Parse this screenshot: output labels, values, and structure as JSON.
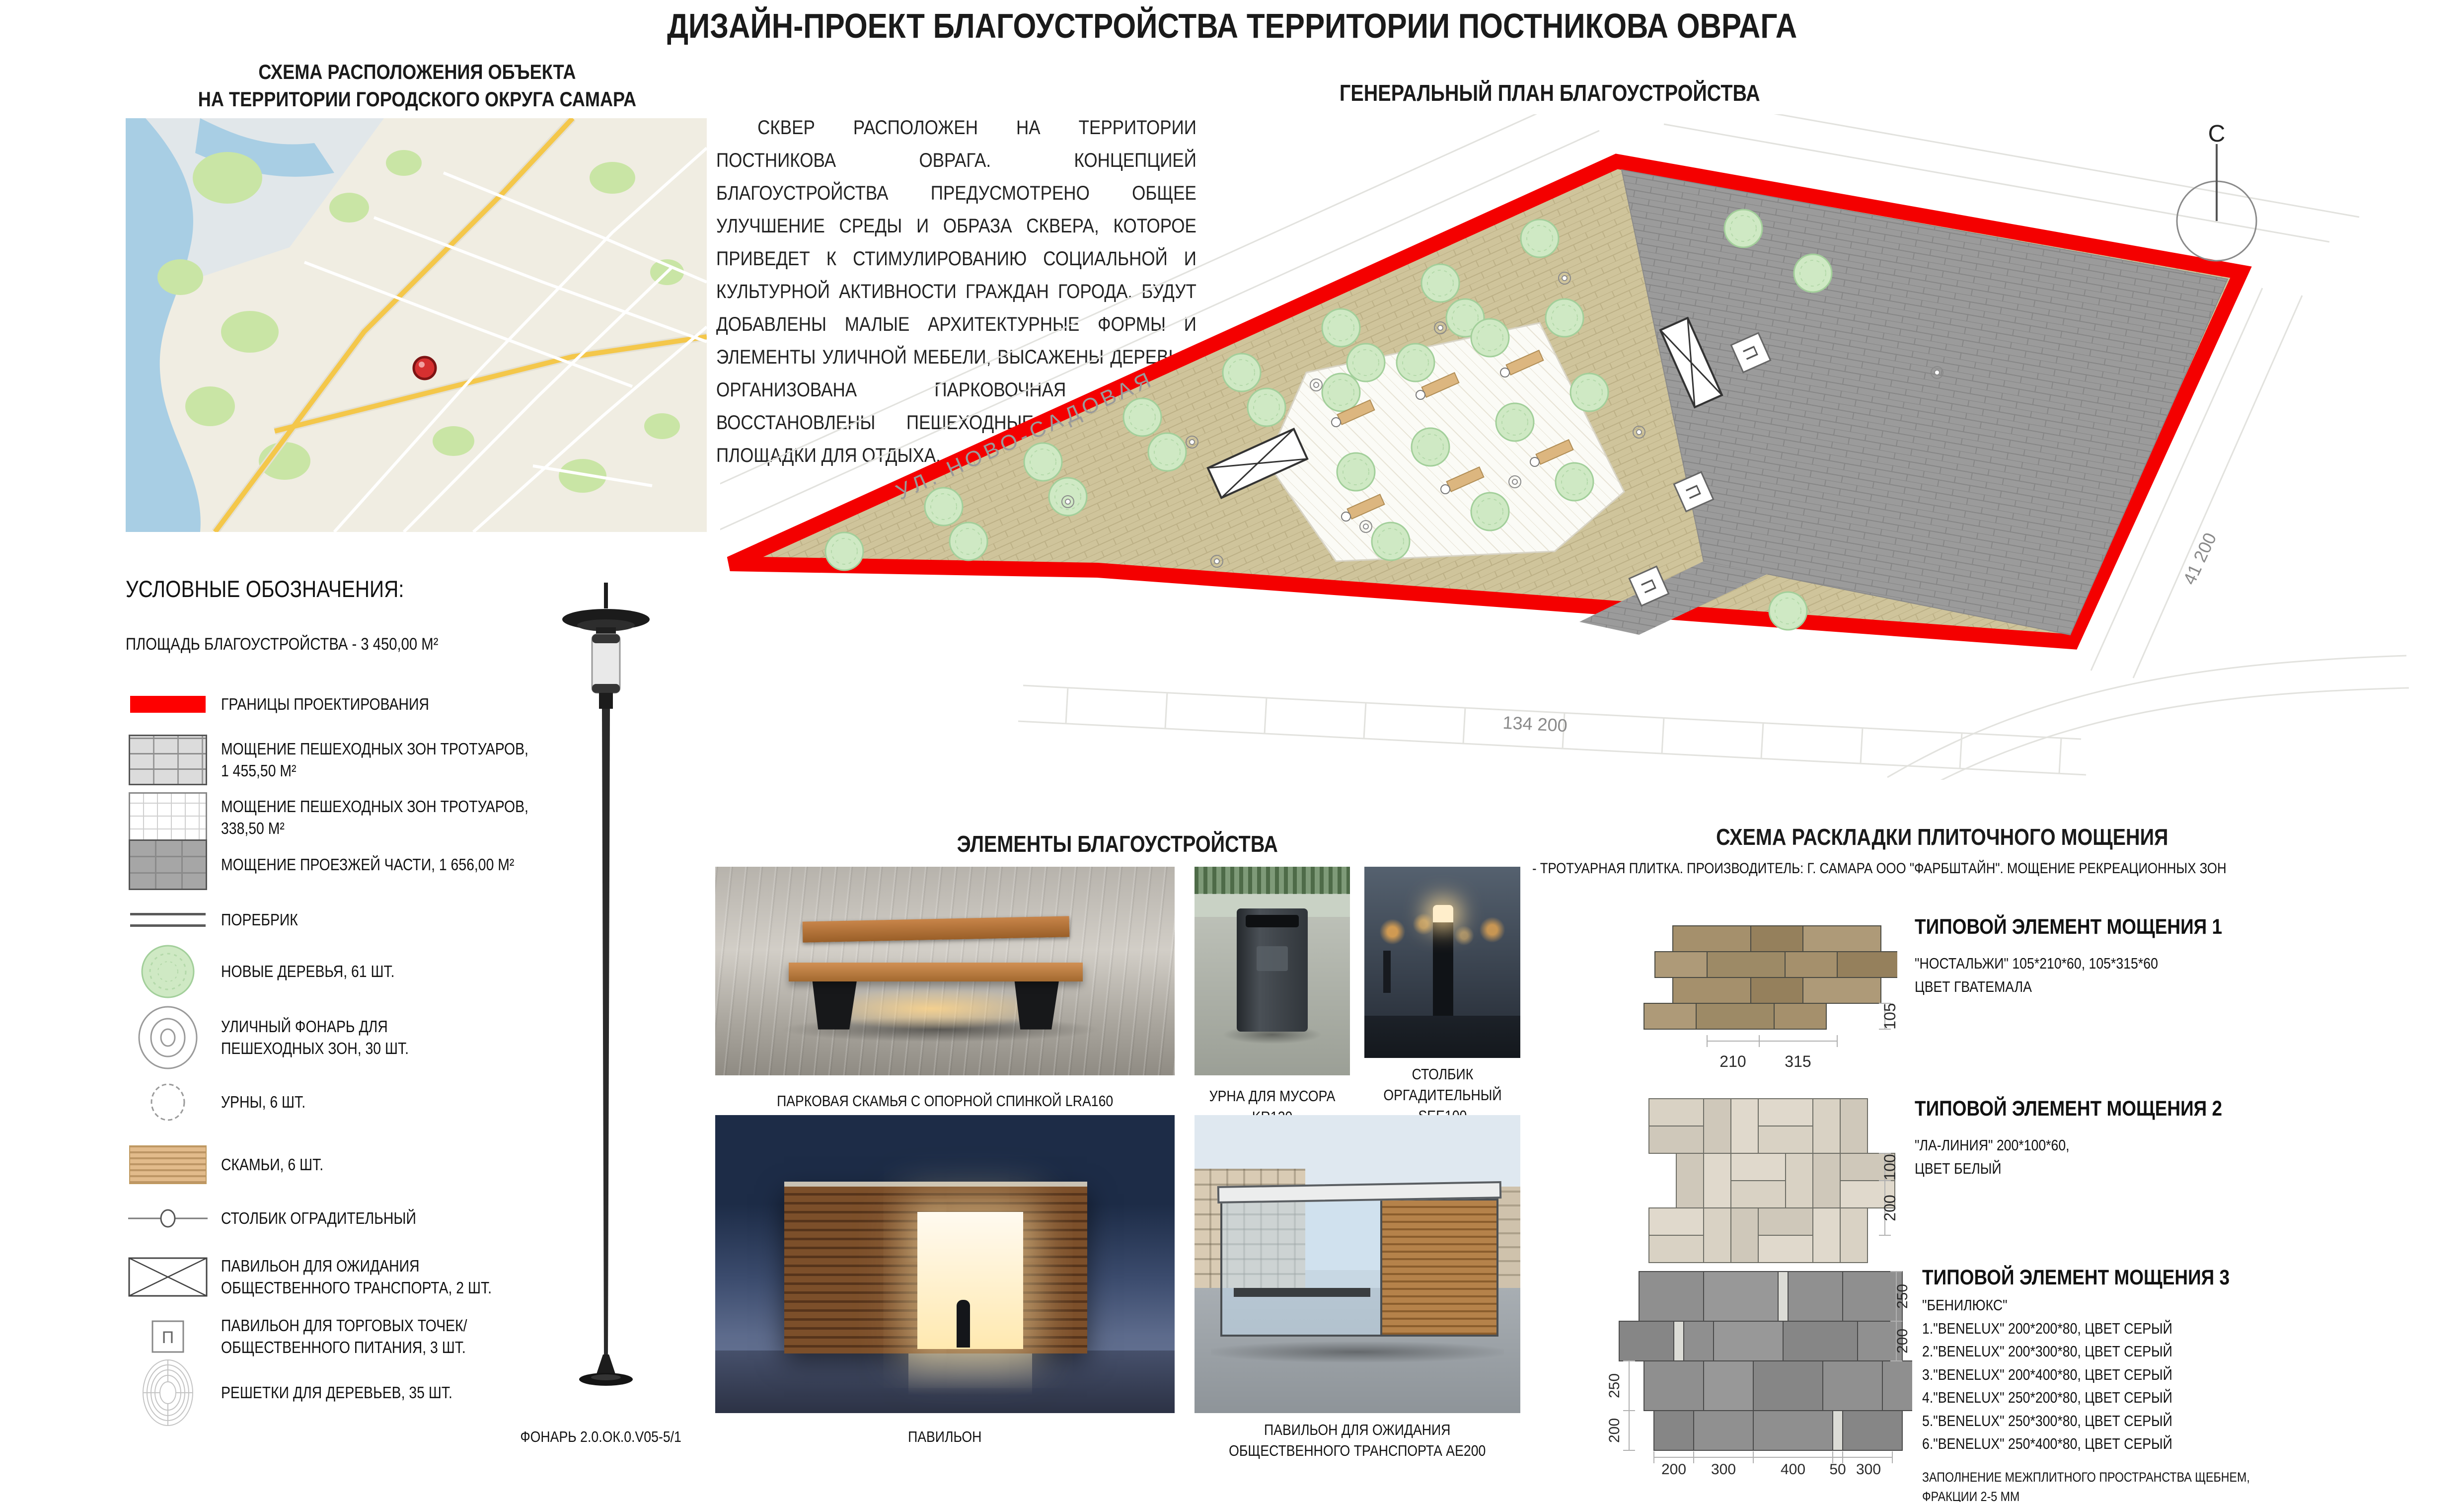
{
  "title": "ДИЗАЙН-ПРОЕКТ БЛАГОУСТРОЙСТВА  ТЕРРИТОРИИ ПОСТНИКОВА ОВРАГА",
  "location_scheme": {
    "title": "СХЕМА РАСПОЛОЖЕНИЯ ОБЪЕКТА\nНА ТЕРРИТОРИИ ГОРОДСКОГО ОКРУГА САМАРА"
  },
  "description": "СКВЕР РАСПОЛОЖЕН НА ТЕРРИТОРИИ ПОСТНИКОВА ОВРАГА. КОНЦЕПЦИЕЙ БЛАГОУСТРОЙСТВА ПРЕДУСМОТРЕНО ОБЩЕЕ УЛУЧШЕНИЕ СРЕДЫ И ОБРАЗА СКВЕРА, КОТОРОЕ ПРИВЕДЕТ К СТИМУЛИРОВАНИЮ СОЦИАЛЬНОЙ И КУЛЬТУРНОЙ АКТИВНОСТИ ГРАЖДАН ГОРОДА. БУДУТ ДОБАВЛЕНЫ МАЛЫЕ АРХИТЕКТУРНЫЕ ФОРМЫ И ЭЛЕМЕНТЫ УЛИЧНОЙ МЕБЕЛИ, ВЫСАЖЕНЫ ДЕРЕВЬЯ, ОРГАНИЗОВАНА ПАРКОВОЧНАЯ ЗОНА, ВОССТАНОВЛЕНЫ ПЕШЕХОДНЫЕ ДОРОЖКИ И ПЛОЩАДКИ ДЛЯ ОТДЫХА.",
  "general_plan": {
    "title": "ГЕНЕРАЛЬНЫЙ ПЛАН БЛАГОУСТРОЙСТВА",
    "street_label": "УЛ. НОВО-САДОВАЯ",
    "dim_bottom": "134 200",
    "dim_right": "41 200",
    "north_label": "С",
    "pavilion_marker": "П"
  },
  "legend": {
    "heading": "УСЛОВНЫЕ ОБОЗНАЧЕНИЯ:",
    "area_line": "ПЛОЩАДЬ БЛАГОУСТРОЙСТВА - 3 450,00 М²",
    "items": [
      {
        "label": "ГРАНИЦЫ ПРОЕКТИРОВАНИЯ"
      },
      {
        "label": "МОЩЕНИЕ ПЕШЕХОДНЫХ ЗОН ТРОТУАРОВ,\n1 455,50 М²"
      },
      {
        "label": "МОЩЕНИЕ ПЕШЕХОДНЫХ ЗОН ТРОТУАРОВ,\n338,50 М²"
      },
      {
        "label": "МОЩЕНИЕ ПРОЕЗЖЕЙ ЧАСТИ, 1 656,00 М²"
      },
      {
        "label": "ПОРЕБРИК"
      },
      {
        "label": "НОВЫЕ ДЕРЕВЬЯ, 61 ШТ."
      },
      {
        "label": "УЛИЧНЫЙ ФОНАРЬ ДЛЯ\nПЕШЕХОДНЫХ ЗОН, 30 ШТ."
      },
      {
        "label": "УРНЫ, 6 ШТ."
      },
      {
        "label": "СКАМЬИ, 6 ШТ."
      },
      {
        "label": "СТОЛБИК ОГРАДИТЕЛЬНЫЙ"
      },
      {
        "label": "ПАВИЛЬОН ДЛЯ ОЖИДАНИЯ\nОБЩЕСТВЕННОГО ТРАНСПОРТА, 2 ШТ."
      },
      {
        "label": "ПАВИЛЬОН ДЛЯ ТОРГОВЫХ ТОЧЕК/\nОБЩЕСТВЕННОГО ПИТАНИЯ, 3 ШТ."
      },
      {
        "label": "РЕШЕТКИ ДЛЯ ДЕРЕВЬЕВ, 35 ШТ."
      }
    ],
    "lamp_caption": "ФОНАРЬ 2.0.ОК.0.V05-5/1"
  },
  "elements": {
    "heading": "ЭЛЕМЕНТЫ БЛАГОУСТРОЙСТВА",
    "bench_caption": "ПАРКОВАЯ СКАМЬЯ С ОПОРНОЙ СПИНКОЙ LRA160",
    "urn_caption": "УРНА ДЛЯ МУСОРА\nKR120",
    "bollard_caption": "СТОЛБИК\nОРГАДИТЕЛЬНЫЙ\nSEE100",
    "pavilion_caption": "ПАВИЛЬОН",
    "bus_caption": "ПАВИЛЬОН ДЛЯ ОЖИДАНИЯ\nОБЩЕСТВЕННОГО ТРАНСПОРТА АЕ200"
  },
  "paving": {
    "heading": "СХЕМА РАСКЛАДКИ ПЛИТОЧНОГО МОЩЕНИЯ",
    "subtitle": "- ТРОТУАРНАЯ ПЛИТКА. ПРОИЗВОДИТЕЛЬ: Г. САМАРА ООО \"ФАРБШТАЙН\". МОЩЕНИЕ РЕКРЕАЦИОННЫХ ЗОН",
    "element1": {
      "title": "ТИПОВОЙ ЭЛЕМЕНТ МОЩЕНИЯ 1",
      "line1": "\"НОСТАЛЬЖИ\" 105*210*60, 105*315*60",
      "line2": "ЦВЕТ ГВАТЕМАЛА",
      "dim_w1": "210",
      "dim_w2": "315",
      "dim_h": "105"
    },
    "element2": {
      "title": "ТИПОВОЙ ЭЛЕМЕНТ МОЩЕНИЯ 2",
      "line1": "\"ЛА-ЛИНИЯ\" 200*100*60,",
      "line2": "ЦВЕТ БЕЛЫЙ",
      "dim_h1": "100",
      "dim_h2": "200"
    },
    "element3": {
      "title": "ТИПОВОЙ ЭЛЕМЕНТ МОЩЕНИЯ 3",
      "line1": "\"БЕНИЛЮКС\"",
      "list": [
        "1.\"BENELUX\" 200*200*80, ЦВЕТ СЕРЫЙ",
        "2.\"BENELUX\" 200*300*80, ЦВЕТ СЕРЫЙ",
        "3.\"BENELUX\" 200*400*80, ЦВЕТ СЕРЫЙ",
        "4.\"BENELUX\" 250*200*80, ЦВЕТ СЕРЫЙ",
        "5.\"BENELUX\" 250*300*80, ЦВЕТ СЕРЫЙ",
        "6.\"BENELUX\" 250*400*80, ЦВЕТ СЕРЫЙ"
      ],
      "note": "ЗАПОЛНЕНИЕ МЕЖПЛИТНОГО ПРОСТРАНСТВА ЩЕБНЕМ,\nФРАКЦИИ 2-5 ММ",
      "dims_bottom": [
        "200",
        "300",
        "400",
        "50",
        "300"
      ],
      "dims_left": [
        "250",
        "200"
      ],
      "dims_right": [
        "250",
        "200"
      ]
    }
  },
  "colors": {
    "boundary_red": "#fe0000",
    "plan_tan": "#cfc49b",
    "plan_gray": "#9b9b9b",
    "tree_green": "#cfe9c4"
  }
}
